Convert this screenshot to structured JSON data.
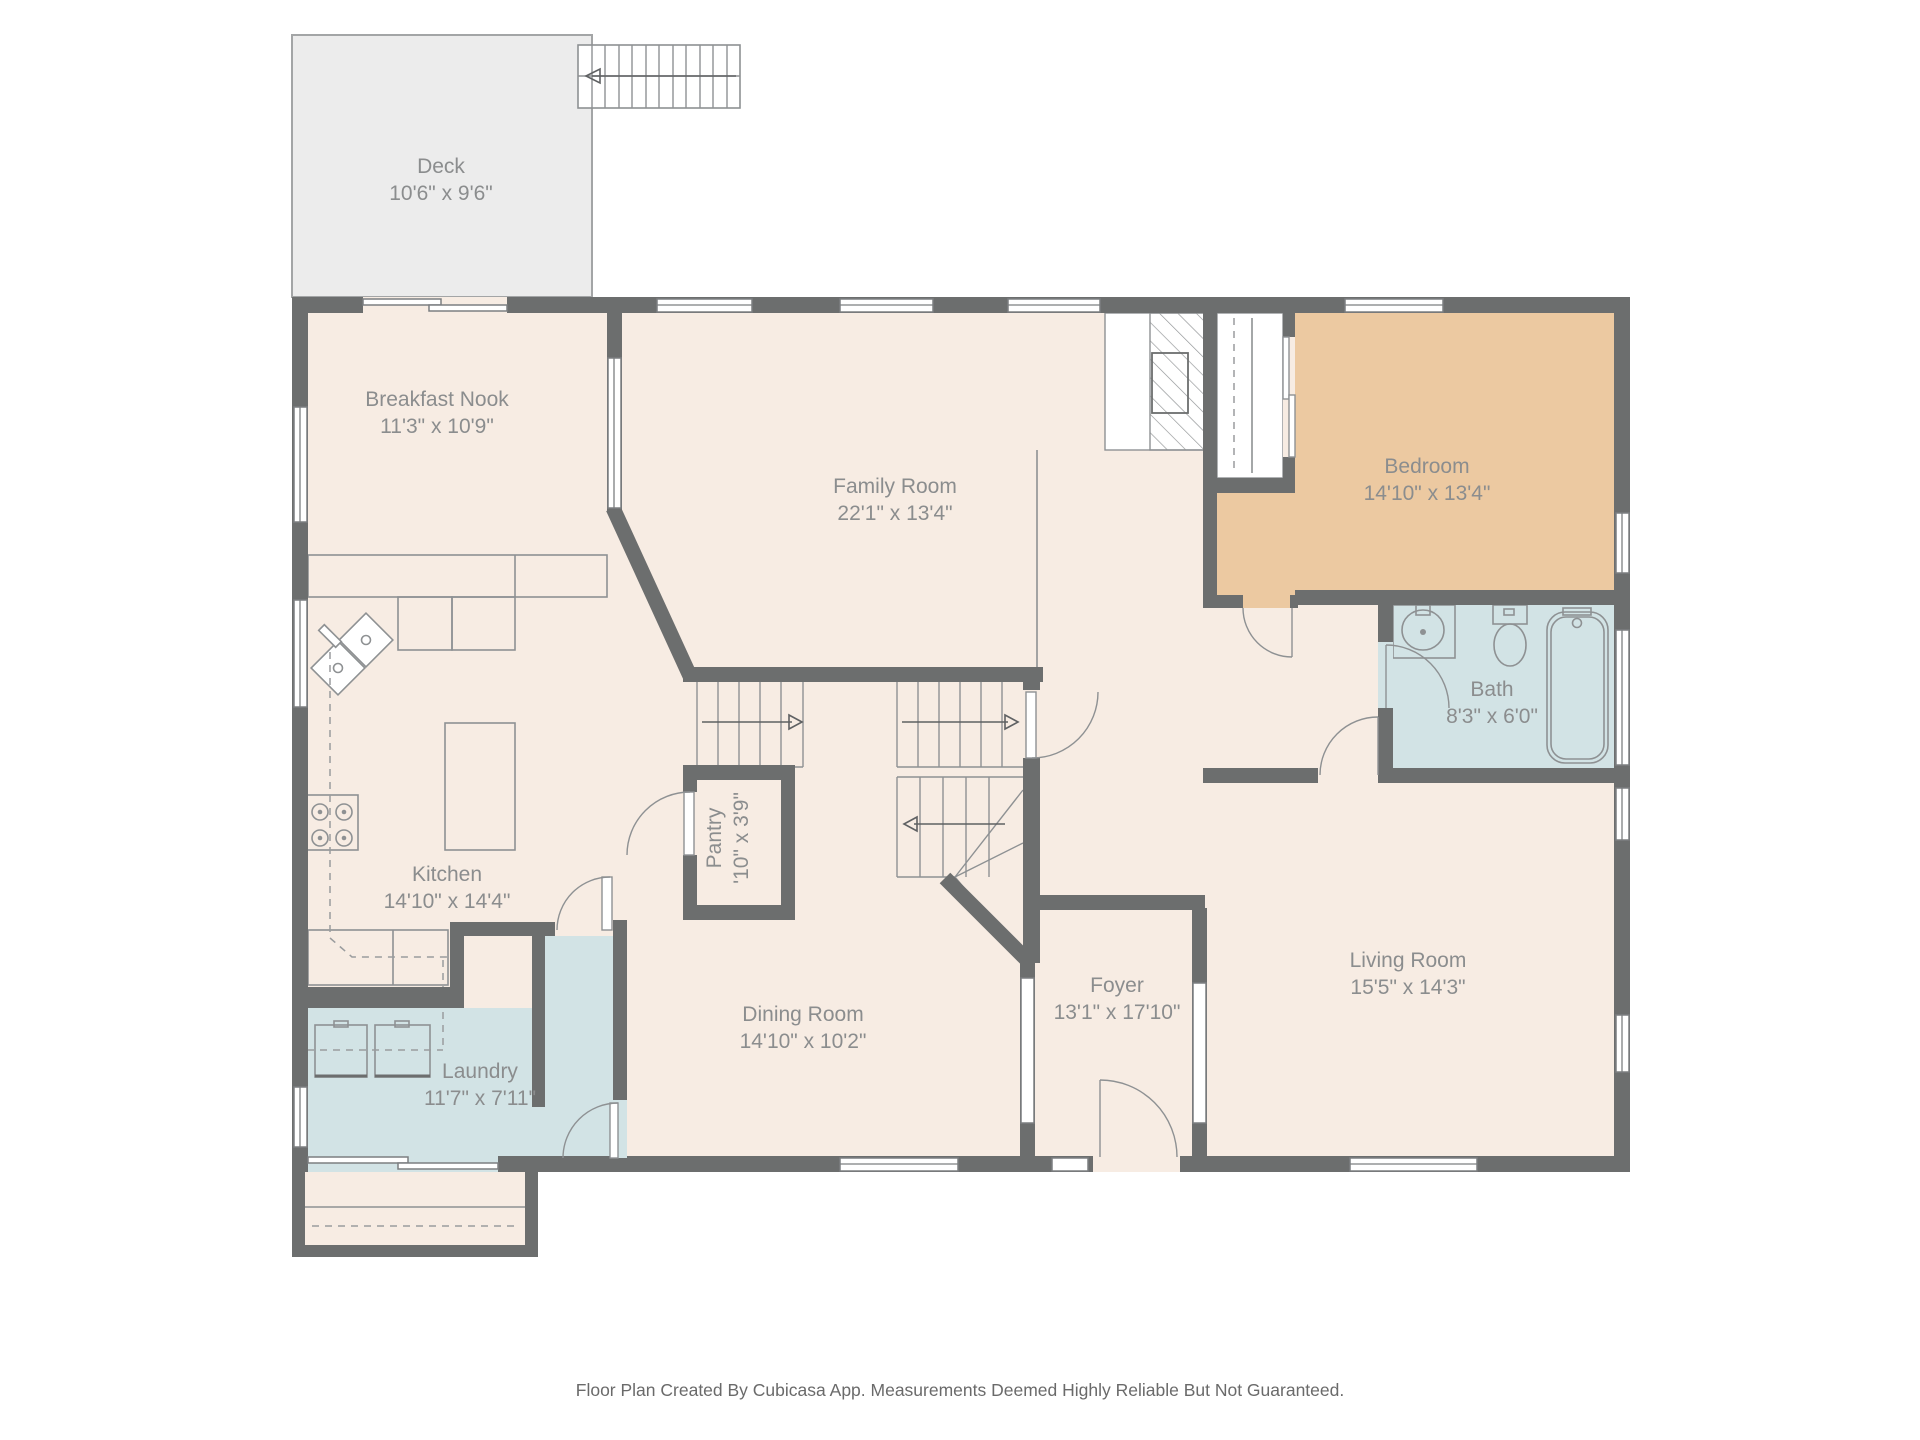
{
  "rooms": {
    "deck": {
      "name": "Deck",
      "dims": "10'6\" x 9'6\""
    },
    "breakfast_nook": {
      "name": "Breakfast Nook",
      "dims": "11'3\" x 10'9\""
    },
    "family_room": {
      "name": "Family Room",
      "dims": "22'1\" x 13'4\""
    },
    "bedroom": {
      "name": "Bedroom",
      "dims": "14'10\" x 13'4\""
    },
    "bath": {
      "name": "Bath",
      "dims": "8'3\" x 6'0\""
    },
    "kitchen": {
      "name": "Kitchen",
      "dims": "14'10\" x 14'4\""
    },
    "pantry": {
      "name": "Pantry",
      "dims": "'10\" x 3'9\""
    },
    "dining_room": {
      "name": "Dining Room",
      "dims": "14'10\" x 10'2\""
    },
    "foyer": {
      "name": "Foyer",
      "dims": "13'1\" x 17'10\""
    },
    "living_room": {
      "name": "Living Room",
      "dims": "15'5\" x 14'3\""
    },
    "laundry": {
      "name": "Laundry",
      "dims": "11'7\" x 7'11\""
    }
  },
  "footer": {
    "disclaimer": "Floor Plan Created By Cubicasa App. Measurements Deemed Highly Reliable But Not Guaranteed."
  },
  "colors": {
    "wall": "#6c6e6e",
    "room_fill": "#f7ece3",
    "wet_room_fill": "#d2e3e5",
    "bedroom_fill": "#ecc9a1",
    "deck_fill": "#ececec",
    "label_text": "#8b8d8e"
  }
}
